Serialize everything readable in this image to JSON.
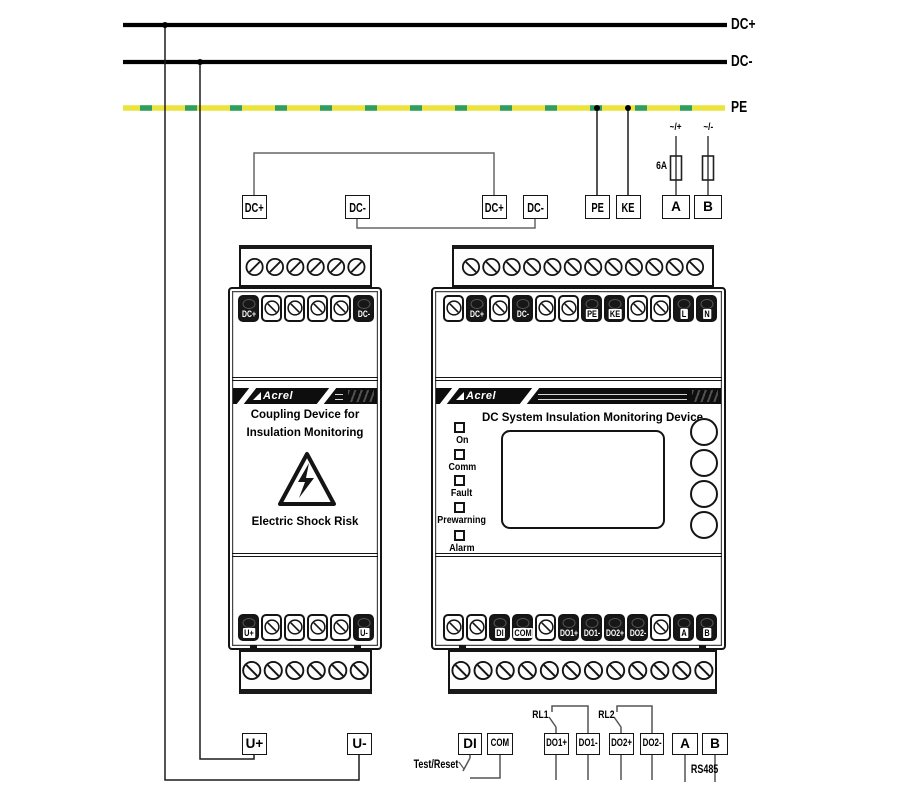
{
  "buses": {
    "dc_plus": "DC+",
    "dc_minus": "DC-",
    "pe": "PE"
  },
  "colors": {
    "pe_yellow": "#ece43c",
    "pe_green": "#2f9e63",
    "panel_dark": "#171717"
  },
  "top_row": {
    "dc_plus_1": "DC+",
    "dc_minus_1": "DC-",
    "dc_plus_2": "DC+",
    "dc_minus_2": "DC-",
    "pe": "PE",
    "ke": "KE",
    "a": "A",
    "b": "B",
    "fuse_plus": "~/+",
    "fuse_minus": "~/-",
    "fuse_rating": "6A"
  },
  "left_device": {
    "brand": "Acrel",
    "title_line1": "Coupling Device for",
    "title_line2": "Insulation Monitoring",
    "warning": "Electric Shock Risk",
    "top_terminals": [
      "DC+",
      "",
      "",
      "",
      "",
      "DC-"
    ],
    "bottom_terminals": [
      "U+",
      "",
      "",
      "",
      "",
      "U-"
    ]
  },
  "right_device": {
    "brand": "Acrel",
    "title": "DC System Insulation Monitoring Device",
    "leds": [
      "On",
      "Comm",
      "Fault",
      "Prewarning",
      "Alarm"
    ],
    "top_terminals": [
      "",
      "DC+",
      "",
      "DC-",
      "",
      "",
      "PE",
      "KE",
      "",
      "",
      "L",
      "N"
    ],
    "bottom_terminals": [
      "",
      "",
      "DI",
      "COM",
      "",
      "DO1+",
      "DO1-",
      "DO2+",
      "DO2-",
      "",
      "A",
      "B"
    ]
  },
  "bottom_row": {
    "u_plus": "U+",
    "u_minus": "U-",
    "di": "DI",
    "com": "COM",
    "do1_plus": "DO1+",
    "do1_minus": "DO1-",
    "do2_plus": "DO2+",
    "do2_minus": "DO2-",
    "a": "A",
    "b": "B",
    "rl1": "RL1",
    "rl2": "RL2",
    "rs485": "RS485",
    "test_reset": "Test/Reset"
  }
}
